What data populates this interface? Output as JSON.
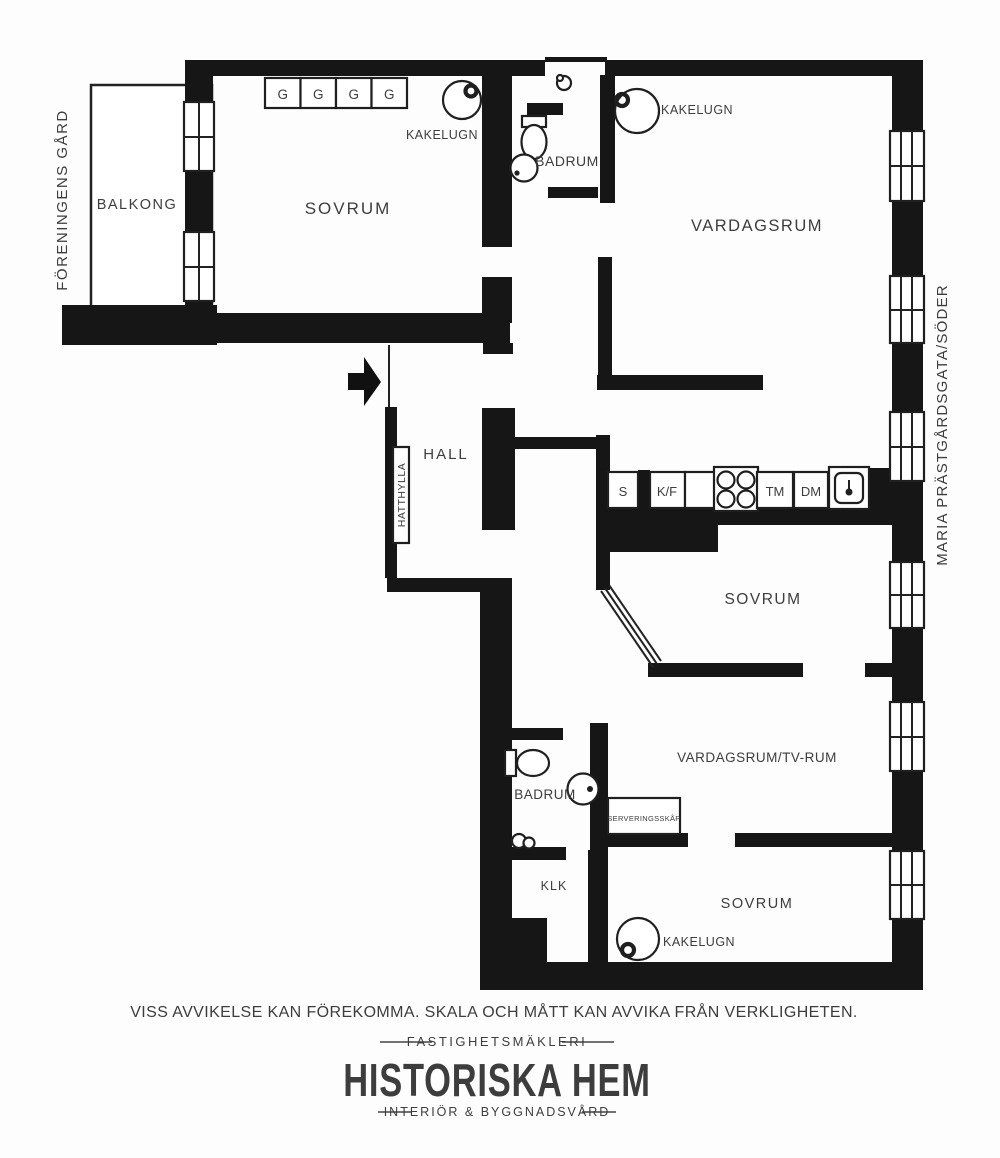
{
  "colors": {
    "background": "#fdfdfd",
    "wall": "#161616",
    "line": "#222222",
    "label": "#3d3d3d",
    "footer_text": "#454545",
    "logo": "#1a1a1a"
  },
  "side_labels": {
    "left": "FÖRENINGENS GÅRD",
    "right": "MARIA PRÄSTGÅRDSGATA/SÖDER"
  },
  "rooms": {
    "balcony": "BALKONG",
    "bedroom_top": "SOVRUM",
    "bathroom_top": "BADRUM",
    "livingroom": "VARDAGSRUM",
    "hall": "HALL",
    "bedroom_mid": "SOVRUM",
    "bathroom_lower": "BADRUM",
    "tv_room": "VARDAGSRUM/TV-RUM",
    "closet": "KLK",
    "bedroom_bottom": "SOVRUM"
  },
  "fixtures": {
    "tiled_stove": "KAKELUGN",
    "hat_shelf": "HATTHYLLA",
    "serving_cabinet": "SERVERINGSSKÅP",
    "wardrobes": [
      "G",
      "G",
      "G",
      "G"
    ],
    "kitchen_units": [
      "S",
      "K/F",
      "TM",
      "DM"
    ]
  },
  "footer": {
    "disclaimer": "VISS AVVIKELSE KAN FÖREKOMMA. SKALA OCH MÅTT KAN AVVIKA FRÅN VERKLIGHETEN.",
    "brokerage_tagline": "FASTIGHETSMÄKLERI",
    "brand": "HISTORISKA HEM",
    "brand_subtitle": "INTERIÖR & BYGGNADSVÅRD"
  }
}
